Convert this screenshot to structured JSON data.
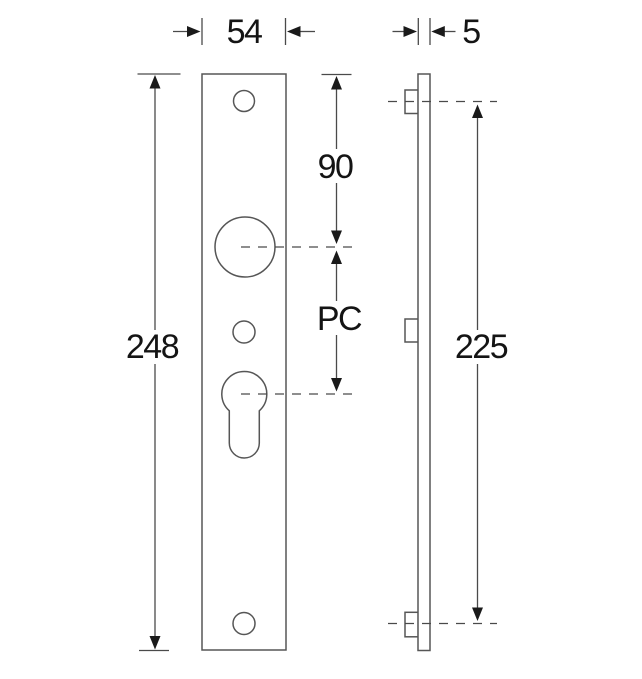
{
  "drawing": {
    "dims": {
      "plate_width": "54",
      "plate_thickness": "5",
      "plate_height": "248",
      "top_hole_to_handle_centre": "90",
      "handle_to_cylinder_centre": "PC",
      "fixing_hole_centres": "225"
    },
    "colors": {
      "line": "#565656",
      "dimension": "#4a4a4a",
      "arrow": "#1a1a1a",
      "text": "#141414",
      "background": "#ffffff"
    }
  }
}
